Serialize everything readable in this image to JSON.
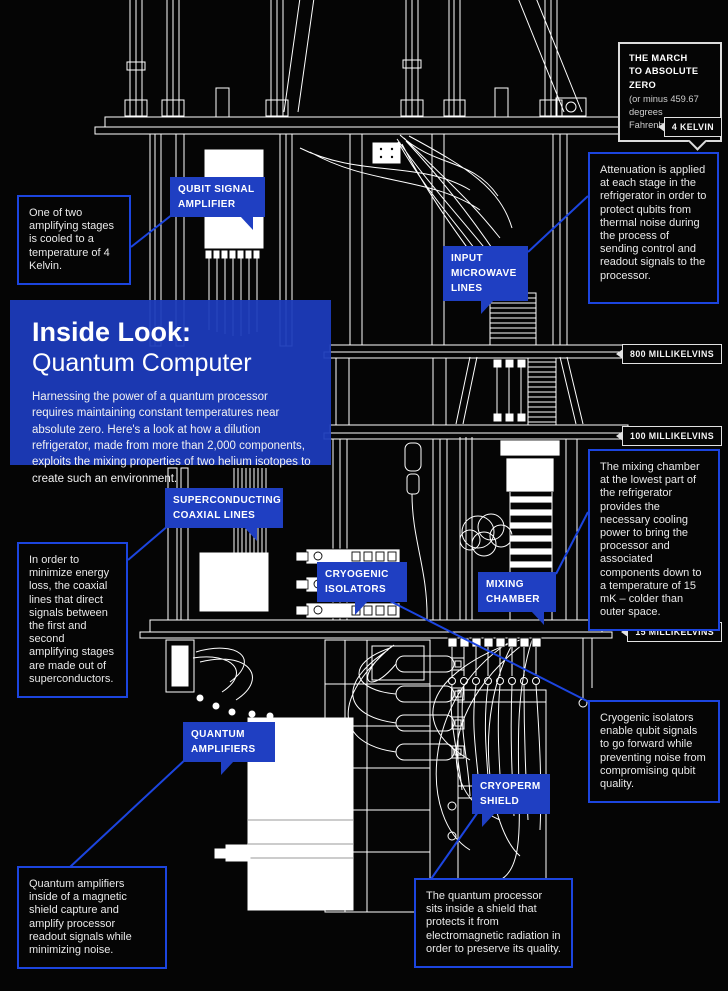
{
  "colors": {
    "background": "#050505",
    "label_blue": "#1f3fc2",
    "panel_blue": "#1d3bbc",
    "connector_blue": "#1c45df",
    "line_white": "#ffffff"
  },
  "march_note": {
    "title": "THE MARCH\nTO ABSOLUTE ZERO",
    "subtitle": "(or minus 459.67\ndegrees Fahrenheit)"
  },
  "temperature_stages": [
    {
      "label": "4 KELVIN"
    },
    {
      "label": "800 MILLIKELVINS"
    },
    {
      "label": "100 MILLIKELVINS"
    },
    {
      "label": "15 MILLIKELVINS"
    }
  ],
  "component_labels": {
    "qubit_signal_amplifier": "QUBIT SIGNAL AMPLIFIER",
    "input_microwave_lines": "INPUT MICROWAVE LINES",
    "superconducting_coaxial_lines": "SUPERCONDUCTING COAXIAL LINES",
    "cryogenic_isolators": "CRYOGENIC ISOLATORS",
    "mixing_chamber": "MIXING CHAMBER",
    "quantum_amplifiers": "QUANTUM AMPLIFIERS",
    "cryoperm_shield": "CRYOPERM SHIELD"
  },
  "title_panel": {
    "heading": "Inside Look:",
    "subheading": "Quantum Computer",
    "body": "Harnessing the power of a quantum processor requires maintaining constant temperatures near absolute zero.  Here's a look at how a dilution refrigerator, made from more than 2,000 components, exploits the mixing properties of two helium isotopes to create such an environment."
  },
  "callouts": {
    "amplifying_stage": "One of two amplifying stages is cooled to a temperature of 4 Kelvin.",
    "attenuation": "Attenuation is applied at each stage in the refrigerator in order to protect qubits from thermal noise during the process of sending control and readout signals to the processor.",
    "superconductors": "In order to minimize energy loss, the coaxial lines that direct signals between the first and second amplifying stages are made out of superconductors.",
    "mixing_chamber": "The mixing chamber at the lowest part of the refrigerator provides the necessary cooling power to bring the processor and associated components down to a temperature of 15 mK – colder than outer space.",
    "cryogenic_isolators": "Cryogenic isolators enable qubit signals to go forward while preventing noise from compromising qubit quality.",
    "quantum_amplifiers": "Quantum amplifiers inside of a magnetic shield capture and amplify processor readout signals while minimizing noise.",
    "processor_shield": "The quantum processor sits inside a shield that protects it from electromagnetic radiation in order to preserve its quality."
  }
}
